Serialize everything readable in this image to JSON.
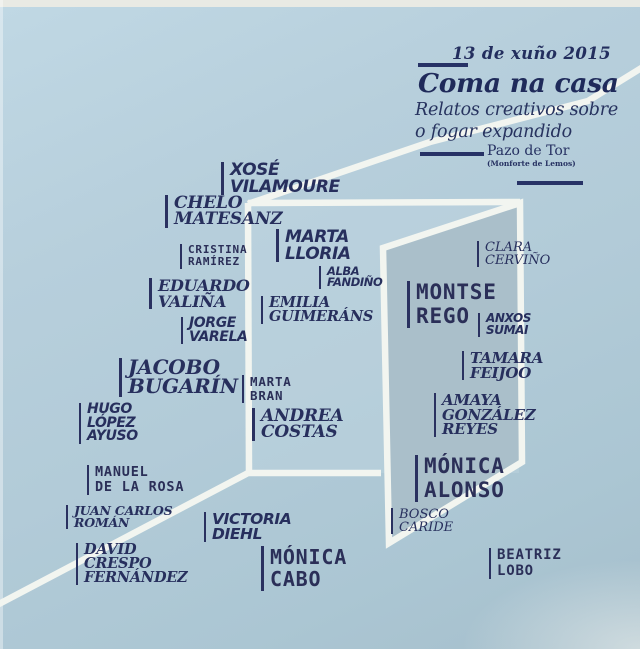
{
  "header": {
    "date": "13 de xuño 2015",
    "title": "Coma na casa",
    "subtitle1": "Relatos creativos sobre",
    "subtitle2": "o fogar expandido",
    "venue": "Pazo de Tor",
    "venue_detail": "(Monforte de Lemos)"
  },
  "colors": {
    "background": "#b4cdda",
    "text_navy": "#272f5d",
    "line_white": "#f2f5f0",
    "door_fill": "#aabfca",
    "bar_navy": "#273266"
  },
  "names": [
    {
      "id": "xose-vilamoure",
      "lines": [
        "XOSÉ",
        "VILAMOURE"
      ],
      "font": "sans",
      "x": 221,
      "y": 162,
      "size": 17
    },
    {
      "id": "chelo-matesanz",
      "lines": [
        "CHELO",
        "MATESANZ"
      ],
      "font": "serif",
      "x": 165,
      "y": 195,
      "size": 17
    },
    {
      "id": "marta-lloria",
      "lines": [
        "MARTA",
        "LLORIA"
      ],
      "font": "sans",
      "x": 276,
      "y": 229,
      "size": 17
    },
    {
      "id": "cristina-ramirez",
      "lines": [
        "CRISTINA",
        "RAMÍREZ"
      ],
      "font": "mono",
      "x": 180,
      "y": 244,
      "size": 11
    },
    {
      "id": "alba-fandino",
      "lines": [
        "ALBA",
        "FANDIÑO"
      ],
      "font": "sans",
      "x": 319,
      "y": 266,
      "size": 11.5
    },
    {
      "id": "eduardo-valina",
      "lines": [
        "EDUARDO",
        "VALIÑA"
      ],
      "font": "serif",
      "x": 149,
      "y": 278,
      "size": 16
    },
    {
      "id": "emilia-guimerans",
      "lines": [
        "EMILIA",
        "GUIMERÁNS"
      ],
      "font": "serif",
      "x": 261,
      "y": 296,
      "size": 14.5
    },
    {
      "id": "jorge-varela",
      "lines": [
        "JORGE",
        "VARELA"
      ],
      "font": "sans",
      "x": 181,
      "y": 317,
      "size": 14
    },
    {
      "id": "clara-cervino",
      "lines": [
        "CLARA",
        "CERVIÑO"
      ],
      "font": "serif-light",
      "x": 477,
      "y": 241,
      "size": 13
    },
    {
      "id": "montse-rego",
      "lines": [
        "MONTSE",
        "REGO"
      ],
      "font": "mono",
      "x": 407,
      "y": 281,
      "size": 21
    },
    {
      "id": "anxos-sumai",
      "lines": [
        "ANXOS",
        "SUMAI"
      ],
      "font": "sans",
      "x": 478,
      "y": 313,
      "size": 12
    },
    {
      "id": "tamara-feijoo",
      "lines": [
        "TAMARA",
        "FEIJOO"
      ],
      "font": "serif",
      "x": 462,
      "y": 351,
      "size": 15
    },
    {
      "id": "jacobo-bugarin",
      "lines": [
        "JACOBO",
        "BUGARÍN"
      ],
      "font": "serif",
      "x": 119,
      "y": 358,
      "size": 20
    },
    {
      "id": "marta-bran",
      "lines": [
        "MARTA",
        "BRAN"
      ],
      "font": "mono",
      "x": 242,
      "y": 375,
      "size": 12.5
    },
    {
      "id": "andrea-costas",
      "lines": [
        "ANDREA",
        "COSTAS"
      ],
      "font": "serif",
      "x": 252,
      "y": 408,
      "size": 17
    },
    {
      "id": "amaya-gonzalez-reyes",
      "lines": [
        "AMAYA",
        "GONZÁLEZ",
        "REYES"
      ],
      "font": "serif",
      "x": 434,
      "y": 393,
      "size": 15
    },
    {
      "id": "hugo-lopez-ayuso",
      "lines": [
        "HUGO",
        "LÓPEZ",
        "AYUSO"
      ],
      "font": "sans",
      "x": 79,
      "y": 403,
      "size": 14
    },
    {
      "id": "monica-alonso",
      "lines": [
        "MÓNICA",
        "ALONSO"
      ],
      "font": "mono",
      "x": 415,
      "y": 455,
      "size": 21
    },
    {
      "id": "manuel-de-la-rosa",
      "lines": [
        "MANUEL",
        "DE LA ROSA"
      ],
      "font": "mono",
      "x": 87,
      "y": 465,
      "size": 13.5
    },
    {
      "id": "juan-carlos-roman",
      "lines": [
        "JUAN CARLOS",
        "ROMÁN"
      ],
      "font": "serif",
      "x": 66,
      "y": 505,
      "size": 12.5
    },
    {
      "id": "bosco-caride",
      "lines": [
        "BOSCO",
        "CARIDE"
      ],
      "font": "serif-light",
      "x": 391,
      "y": 508,
      "size": 13
    },
    {
      "id": "victoria-diehl",
      "lines": [
        "VICTORIA",
        "DIEHL"
      ],
      "font": "sans",
      "x": 204,
      "y": 512,
      "size": 15.5
    },
    {
      "id": "david-crespo-fernandez",
      "lines": [
        "DAVID",
        "CRESPO",
        "FERNÁNDEZ"
      ],
      "font": "serif",
      "x": 76,
      "y": 543,
      "size": 14.5
    },
    {
      "id": "monica-cabo",
      "lines": [
        "MÓNICA",
        "CABO"
      ],
      "font": "mono",
      "x": 261,
      "y": 546,
      "size": 20
    },
    {
      "id": "beatriz-lobo",
      "lines": [
        "BEATRIZ",
        "LOBO"
      ],
      "font": "mono",
      "x": 489,
      "y": 548,
      "size": 14
    }
  ]
}
